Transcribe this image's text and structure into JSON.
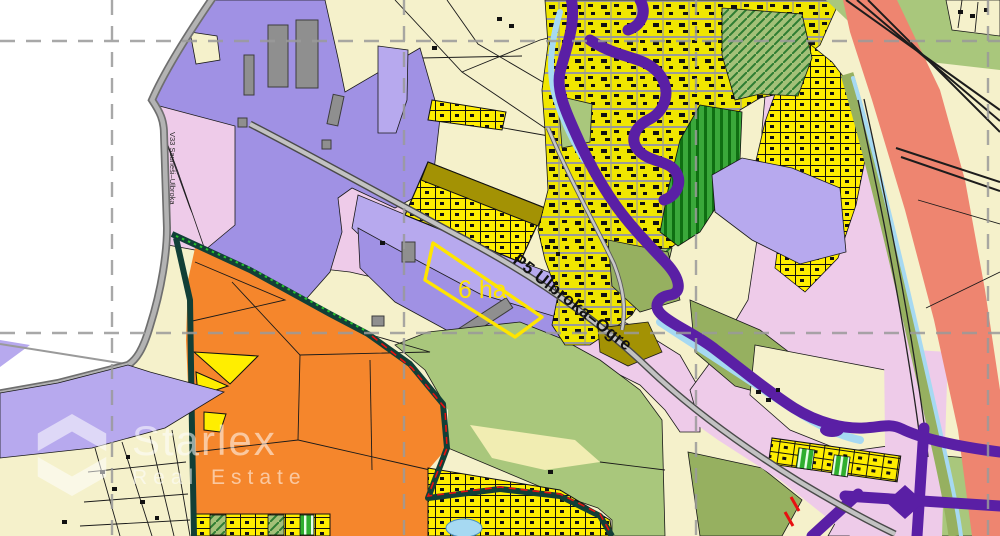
{
  "page": {
    "title": "Territorial land-use zoning map"
  },
  "map": {
    "road_labels": {
      "p5": "P5 Ulbroka–Ogre",
      "v33": "V33 Saurieši–Ulbroka"
    },
    "highlight": {
      "area": "6 ha"
    },
    "watermark": {
      "brand": "Starlex",
      "tagline": "Real Estate"
    },
    "grid": {
      "vertical_x": [
        112,
        404,
        696,
        988
      ],
      "horizontal_y": [
        41,
        333
      ]
    },
    "palette": {
      "zone-cream": "#f5f1cb",
      "zone-cream-pale": "#f1edb2",
      "zone-pink": "#eecbe9",
      "zone-purple": "#a091e4",
      "zone-lavender": "#b7a9ee",
      "zone-orange": "#f5862c",
      "zone-yellow": "#ffee00",
      "zone-olive": "#a39204",
      "zone-green": "#a9c77c",
      "zone-olivegreen": "#96b060",
      "zone-salmon": "#ee8570",
      "urban-yellow": "#f0e600",
      "corridor-purple": "#5a1fa5",
      "river-blue": "#a6d9f2",
      "boundary-teal": "#123f37",
      "highlight-yellow": "#ffe500",
      "mark-red": "#e81010",
      "grid-gray": "#9a9a9a"
    }
  }
}
